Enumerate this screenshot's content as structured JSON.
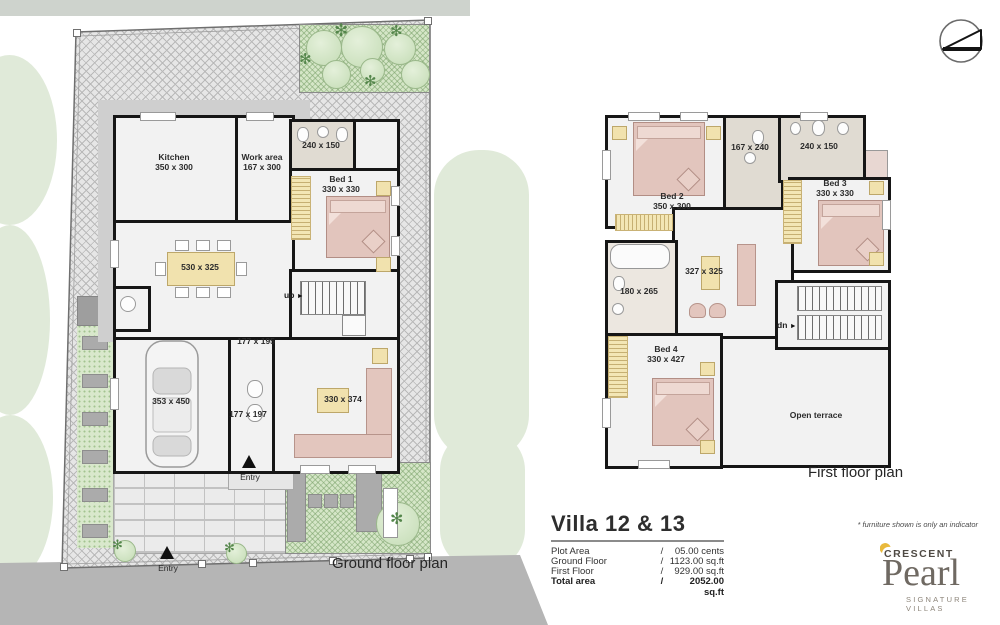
{
  "captions": {
    "ground": "Ground floor plan",
    "first": "First floor plan"
  },
  "icons": {
    "arrow_right": "►",
    "frond": "✻",
    "north_arrow": "north-arrow-symbol"
  },
  "ground_floor": {
    "kitchen": {
      "name": "Kitchen",
      "dims": "350 x 300"
    },
    "work_area": {
      "name": "Work area",
      "dims": "167 x 300"
    },
    "bath": {
      "dims": "240 x 150"
    },
    "bed1": {
      "name": "Bed 1",
      "dims": "330 x 330"
    },
    "dining": {
      "dims": "530 x 325"
    },
    "passage1": {
      "dims": "177 x 195"
    },
    "garage": {
      "dims": "353 x 450"
    },
    "passage2": {
      "dims": "177 x 197"
    },
    "living": {
      "dims": "330 x 374"
    },
    "stair": {
      "label": "up"
    },
    "entries": [
      "Entry",
      "Entry"
    ]
  },
  "first_floor": {
    "bed2": {
      "name": "Bed 2",
      "dims": "350 x 300"
    },
    "bath1": {
      "dims": "167 x 240"
    },
    "bath2": {
      "dims": "240 x 150"
    },
    "bed3": {
      "name": "Bed 3",
      "dims": "330 x 330"
    },
    "hall": {
      "dims": "327 x 325"
    },
    "bath3": {
      "dims": "180 x 265"
    },
    "bed4": {
      "name": "Bed 4",
      "dims": "330 x 427"
    },
    "terrace": {
      "name": "Open terrace"
    },
    "stair": {
      "label": "dn"
    }
  },
  "info": {
    "title": "Villa 12 & 13",
    "rows": [
      {
        "label": "Plot Area",
        "sep": "/",
        "value": "05.00 cents"
      },
      {
        "label": "Ground Floor",
        "sep": "/",
        "value": "1123.00 sq.ft"
      },
      {
        "label": "First Floor",
        "sep": "/",
        "value": "929.00 sq.ft"
      },
      {
        "label": "Total area",
        "sep": "/",
        "value": "2052.00 sq.ft"
      }
    ]
  },
  "branding": {
    "disclaimer": "* furniture shown is only an indicator",
    "brand": "CRESCENT",
    "product": "Pearl",
    "tagline": "SIGNATURE VILLAS"
  },
  "colors": {
    "wall": "#161616",
    "furniture_pink": "#e3c6be",
    "accent_yellow": "#f1e2ae",
    "lawn_green": "#d9e8cc",
    "road_gray": "#b5b5b5",
    "terrace_beige": "#eae2d3",
    "logo_yellow": "#e9b93c"
  }
}
